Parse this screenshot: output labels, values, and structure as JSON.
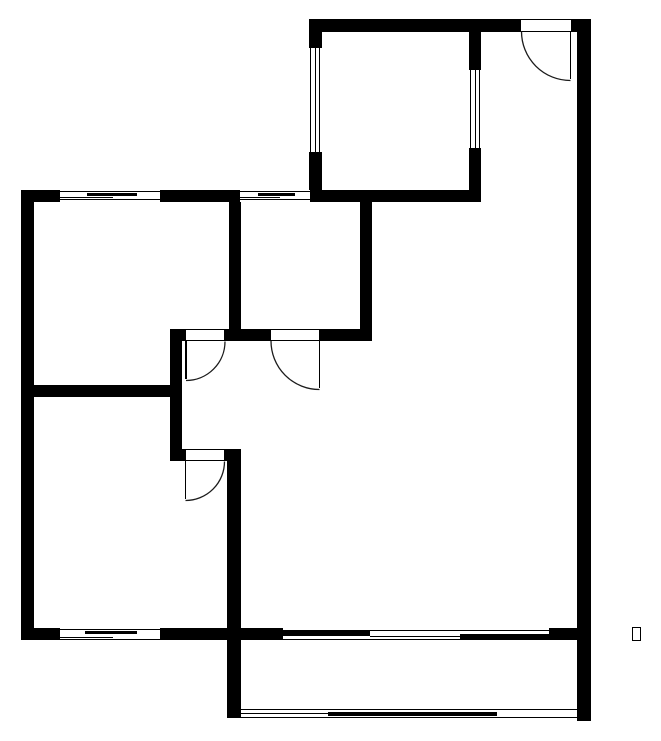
{
  "canvas": {
    "width": 661,
    "height": 741
  },
  "colors": {
    "wall": "#000000",
    "thin_line": "#1b1b1b",
    "background": "#ffffff"
  },
  "floor_plan": {
    "walls": [
      [
        309,
        19,
        211,
        13
      ],
      [
        572,
        19,
        19,
        13
      ],
      [
        309,
        32,
        13,
        16
      ],
      [
        309,
        152,
        13,
        50
      ],
      [
        469,
        32,
        12,
        38
      ],
      [
        469,
        148,
        12,
        54
      ],
      [
        577,
        19,
        14,
        702
      ],
      [
        21,
        190,
        39,
        12
      ],
      [
        160,
        190,
        80,
        12
      ],
      [
        310,
        190,
        171,
        12
      ],
      [
        21,
        190,
        13,
        450
      ],
      [
        229,
        202,
        12,
        127
      ],
      [
        360,
        202,
        12,
        139
      ],
      [
        170,
        329,
        15,
        12
      ],
      [
        225,
        329,
        45,
        12
      ],
      [
        320,
        329,
        52,
        12
      ],
      [
        170,
        341,
        12,
        120
      ],
      [
        21,
        385,
        161,
        12
      ],
      [
        182,
        449,
        3,
        12
      ],
      [
        225,
        449,
        16,
        12
      ],
      [
        227,
        449,
        14,
        269
      ],
      [
        21,
        628,
        39,
        12
      ],
      [
        160,
        628,
        81,
        12
      ],
      [
        241,
        628,
        42,
        12
      ],
      [
        549,
        628,
        28,
        12
      ]
    ],
    "windows": [
      {
        "id": "window-top-left",
        "rect": [
          60,
          190,
          100,
          12
        ],
        "lines": [
          [
            60,
            190.5,
            100,
            1
          ],
          [
            87,
            193,
            50,
            3
          ],
          [
            60,
            197,
            53,
            1
          ],
          [
            60,
            199,
            100,
            1
          ]
        ]
      },
      {
        "id": "window-top-middle",
        "rect": [
          240,
          190,
          70,
          12
        ],
        "lines": [
          [
            240,
            190.5,
            70,
            1
          ],
          [
            258,
            193,
            37,
            3
          ],
          [
            240,
            197,
            40,
            1
          ],
          [
            240,
            199,
            70,
            1
          ]
        ]
      },
      {
        "id": "window-toproom-left",
        "rect": [
          309,
          48,
          13,
          104
        ],
        "lines": [
          [
            310,
            48,
            1,
            104
          ],
          [
            314.5,
            48,
            1,
            104
          ],
          [
            319,
            48,
            1,
            104
          ]
        ]
      },
      {
        "id": "window-toproom-right",
        "rect": [
          469,
          70,
          12,
          78
        ],
        "lines": [
          [
            470,
            70,
            1,
            78
          ],
          [
            474.5,
            70,
            1,
            78
          ],
          [
            479,
            70,
            1,
            78
          ]
        ]
      },
      {
        "id": "window-bottom-left",
        "rect": [
          60,
          628,
          100,
          12
        ],
        "lines": [
          [
            60,
            629,
            100,
            1
          ],
          [
            85,
            631,
            52,
            3
          ],
          [
            60,
            636.5,
            53,
            1
          ],
          [
            60,
            638.5,
            100,
            1
          ]
        ]
      },
      {
        "id": "window-bottom-living",
        "rect": [
          283,
          628,
          266,
          12
        ],
        "lines": [
          [
            283,
            629.5,
            266,
            1
          ],
          [
            283,
            631,
            87,
            5
          ],
          [
            370,
            635.5,
            90,
            1
          ],
          [
            460,
            634,
            89,
            6
          ],
          [
            283,
            638.5,
            178,
            1
          ]
        ]
      },
      {
        "id": "window-balcony-front",
        "rect": [
          241,
          709,
          336,
          10
        ],
        "lines": [
          [
            241,
            709,
            336,
            1
          ],
          [
            241,
            713,
            88,
            1
          ],
          [
            328,
            711.5,
            169,
            4
          ],
          [
            241,
            717,
            336,
            1.2
          ]
        ]
      }
    ],
    "door_openings": [
      {
        "id": "door-opening-entry",
        "rect": [
          520,
          19,
          52,
          13
        ]
      },
      {
        "id": "door-opening-left-room",
        "rect": [
          185,
          329,
          40,
          12
        ]
      },
      {
        "id": "door-opening-middle-room",
        "rect": [
          270,
          329,
          50,
          12
        ]
      },
      {
        "id": "door-opening-lower-left-room",
        "rect": [
          185,
          449,
          40,
          12
        ]
      }
    ],
    "door_leaves": [
      [
        569.5,
        31,
        1.5,
        48
      ],
      [
        185,
        341,
        1.5,
        38
      ],
      [
        318.5,
        341,
        1.5,
        47
      ],
      [
        184.5,
        461,
        1.5,
        38
      ]
    ],
    "door_arcs": [
      {
        "id": "door-arc-entry",
        "d": "M 521.5 31.5 A 49 49 0 0 0 570.5 80.5"
      },
      {
        "id": "door-arc-left-room",
        "d": "M 225 341.5 A 39 39 0 0 1 186 380.5"
      },
      {
        "id": "door-arc-middle-room",
        "d": "M 271 341 A 48.5 48.5 0 0 0 319.5 389.5"
      },
      {
        "id": "door-arc-lower-left-room",
        "d": "M 224.5 461.5 A 39 39 0 0 1 185.5 500.5"
      }
    ],
    "missing_glyph": {
      "rect": [
        632,
        627,
        9,
        14
      ]
    }
  }
}
